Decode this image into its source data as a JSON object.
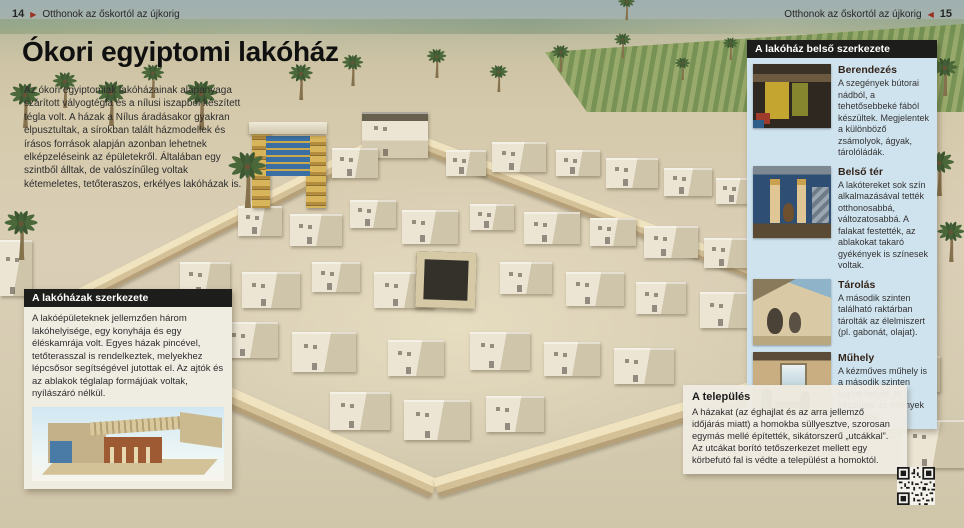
{
  "page_header": {
    "left": {
      "page_number": "14",
      "arrow": "▶",
      "title": "Otthonok az őskortól az újkorig"
    },
    "right": {
      "title": "Otthonok az őskortól az újkorig",
      "arrow": "◀",
      "page_number": "15"
    }
  },
  "main": {
    "title": "Ókori egyiptomi lakóház",
    "intro": "Az ókori egyiptomiak lakóházainak alapanyaga szárított vályogtégla és a nílusi iszapból készített tégla volt. A házak a Nílus áradásakor gyakran elpusztultak, a sírokban talált házmodellek és írásos források alapján azonban lehetnek elképzeléseink az épületekről. Általában egy szintből álltak, de valószínűleg voltak kétemeletes, tetőteraszos, erkélyes lakóházak is."
  },
  "structure_box": {
    "title": "A lakóházak szerkezete",
    "text": "A lakóépületeknek jellemzően három lakóhelyisége, egy konyhája és egy éléskamrája volt. Egyes házak pincével, tetőterasszal is rendelkeztek, melyekhez lépcsősor segítségével jutottak el. Az ajtók és az ablakok téglalap formájúak voltak, nyílászáró nélkül.",
    "illustration": "cutaway-house-model"
  },
  "interior_sidebar": {
    "title": "A lakóház belső szerkezete",
    "entries": [
      {
        "heading": "Berendezés",
        "text": "A szegények bútorai nádból, a tehetősebbeké fából készültek. Megjelentek a különböző zsámolyok, ágyak, tárolóládák.",
        "thumbnail": "furniture-interior-photo"
      },
      {
        "heading": "Belső tér",
        "text": "A lakótereket sok szín alkalmazásával tették otthonosabbá, változatosabbá. A falakat festették, az ablakokat takaró gyékények is színesek voltak.",
        "thumbnail": "painted-interior-photo"
      },
      {
        "heading": "Tárolás",
        "text": "A második szinten található raktárban tárolták az élelmiszert (pl. gabonát, olajat).",
        "thumbnail": "rooftop-storage-photo"
      },
      {
        "heading": "Műhely",
        "text": "A kézműves műhely is a második szinten kapott helyet. Itt készültek az edények és textilek.",
        "thumbnail": "workshop-photo"
      }
    ]
  },
  "settlement_box": {
    "title": "A település",
    "text": "A házakat (az éghajlat és az arra jellemző időjárás miatt) a homokba süllyesztve, szorosan egymás mellé építették, sikátorszerű „utcákkal”. Az utcákat borító tetőszerkezet mellett egy körbefutó fal is védte a települést a homoktól."
  },
  "colors": {
    "header_bar": "#1d1d1b",
    "sidebar_bg": "#cfe3ee",
    "box_bg": "#efece2",
    "arrow_red": "#9c2f1f",
    "sand": "#d6ccb2"
  }
}
